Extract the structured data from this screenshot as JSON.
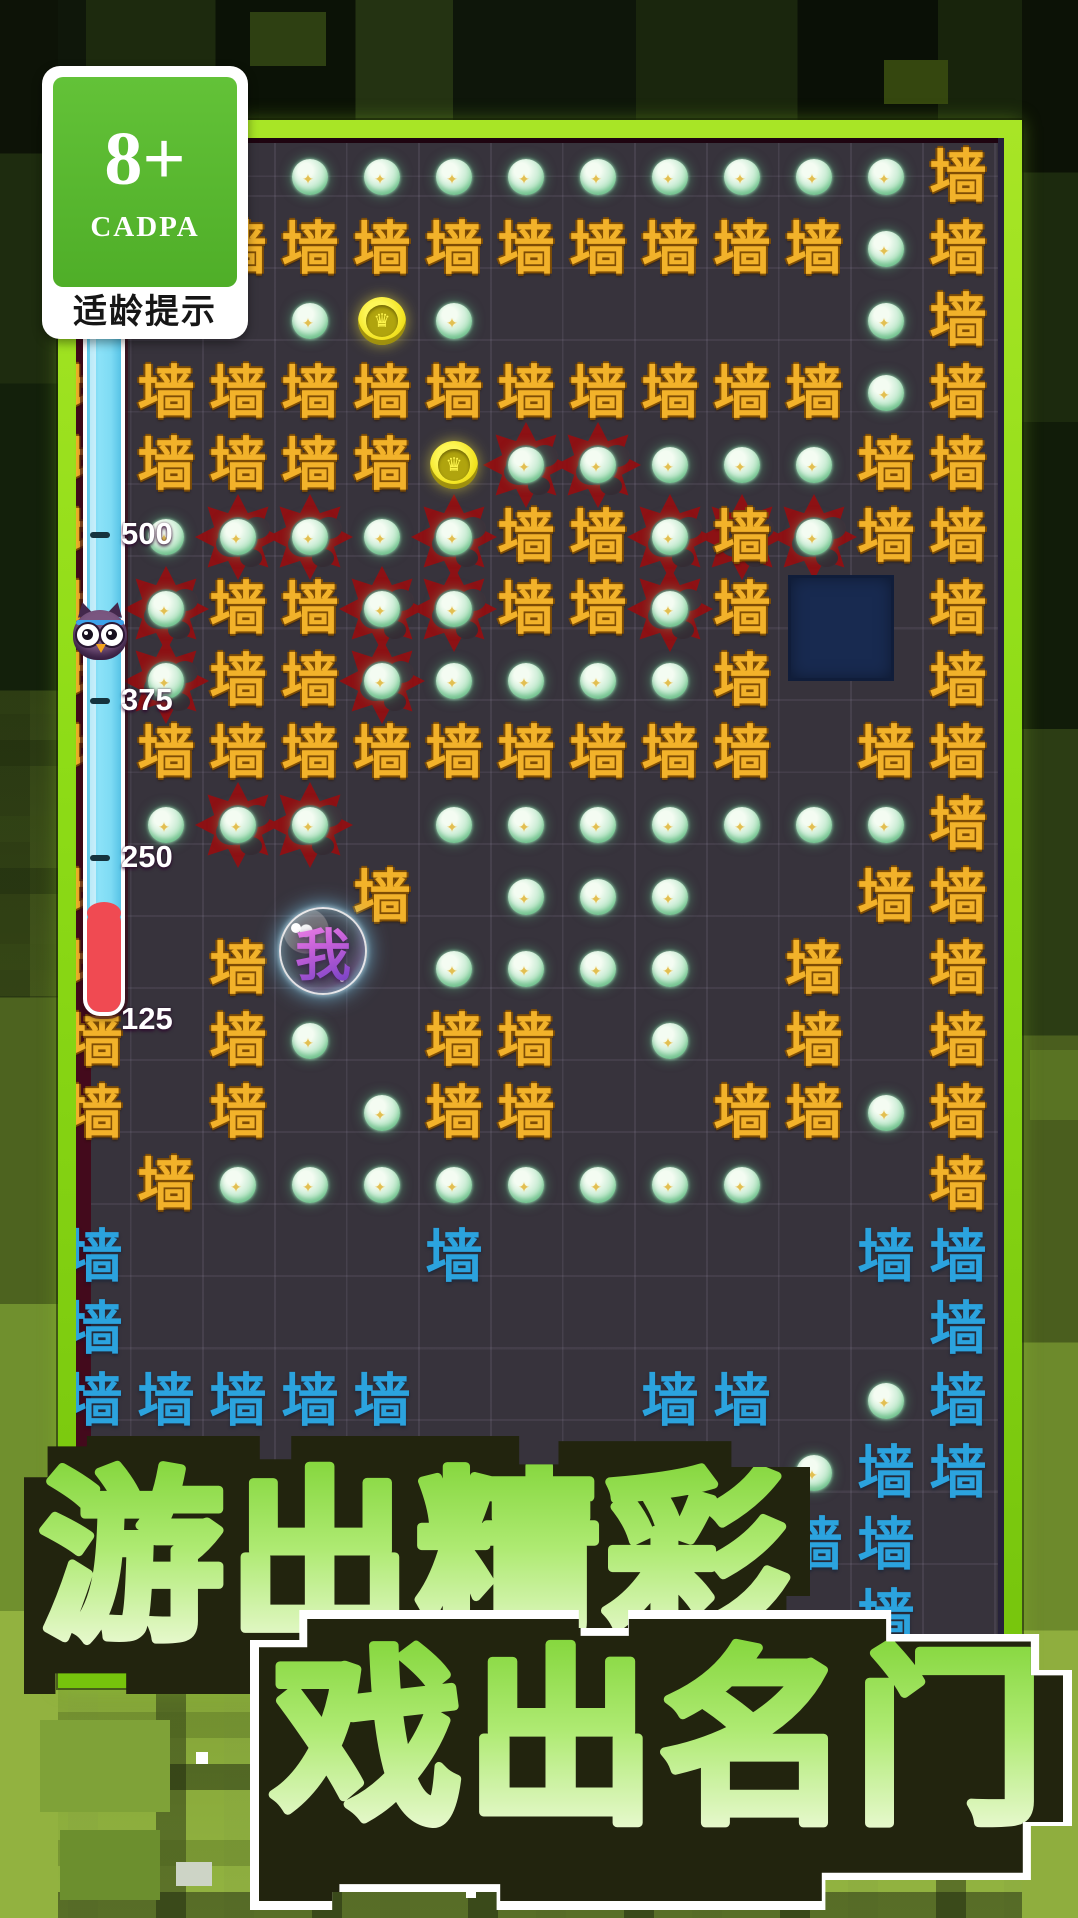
{
  "age_badge": {
    "rating": "8+",
    "org": "CADPA",
    "caption": "适龄提示"
  },
  "title": {
    "line1": "游出精彩",
    "line2": "戏出名门"
  },
  "meter": {
    "labels": [
      {
        "value": "500",
        "y": 535,
        "tick": true
      },
      {
        "value": "375",
        "y": 701,
        "tick": true
      },
      {
        "value": "250",
        "y": 858,
        "tick": true
      },
      {
        "value": "125",
        "y": 1020,
        "tick": false
      }
    ]
  },
  "icons": {
    "orb_star": "✦",
    "coin_crown": "♛",
    "owl": "owl-mascot"
  },
  "colors": {
    "frame_green": "#8edc17",
    "board_bg": "#37333c",
    "gold_wall": "#f2b22a",
    "blue_wall": "#2ba3de",
    "orb_green": "#a4dfb6",
    "coin_yellow": "#f3e422",
    "thorn_red": "#8d1114",
    "danger_red": "#f04a52",
    "meter_cyan": "#7edbf4",
    "navy_block": "#182a50",
    "title_green": "#8edb4a"
  },
  "board": {
    "wall_char": "墙",
    "player_char": "我",
    "gold_walls": [
      [
        12,
        0
      ],
      [
        2,
        1
      ],
      [
        3,
        1
      ],
      [
        4,
        1
      ],
      [
        5,
        1
      ],
      [
        6,
        1
      ],
      [
        7,
        1
      ],
      [
        8,
        1
      ],
      [
        9,
        1
      ],
      [
        10,
        1
      ],
      [
        12,
        1
      ],
      [
        12,
        2
      ],
      [
        0,
        3
      ],
      [
        1,
        3
      ],
      [
        2,
        3
      ],
      [
        3,
        3
      ],
      [
        4,
        3
      ],
      [
        5,
        3
      ],
      [
        6,
        3
      ],
      [
        7,
        3
      ],
      [
        8,
        3
      ],
      [
        9,
        3
      ],
      [
        10,
        3
      ],
      [
        12,
        3
      ],
      [
        0,
        4
      ],
      [
        1,
        4
      ],
      [
        2,
        4
      ],
      [
        3,
        4
      ],
      [
        4,
        4
      ],
      [
        11,
        4
      ],
      [
        12,
        4
      ],
      [
        0,
        5
      ],
      [
        6,
        5
      ],
      [
        7,
        5
      ],
      [
        11,
        5
      ],
      [
        12,
        5
      ],
      [
        0,
        6
      ],
      [
        2,
        6
      ],
      [
        3,
        6
      ],
      [
        6,
        6
      ],
      [
        7,
        6
      ],
      [
        9,
        6
      ],
      [
        12,
        6
      ],
      [
        0,
        7
      ],
      [
        2,
        7
      ],
      [
        3,
        7
      ],
      [
        9,
        7
      ],
      [
        12,
        7
      ],
      [
        0,
        8
      ],
      [
        1,
        8
      ],
      [
        2,
        8
      ],
      [
        3,
        8
      ],
      [
        4,
        8
      ],
      [
        5,
        8
      ],
      [
        6,
        8
      ],
      [
        7,
        8
      ],
      [
        8,
        8
      ],
      [
        9,
        8
      ],
      [
        11,
        8
      ],
      [
        12,
        8
      ],
      [
        12,
        9
      ],
      [
        0,
        10
      ],
      [
        4,
        10
      ],
      [
        11,
        10
      ],
      [
        12,
        10
      ],
      [
        0,
        11
      ],
      [
        2,
        11
      ],
      [
        10,
        11
      ],
      [
        12,
        11
      ],
      [
        0,
        12
      ],
      [
        2,
        12
      ],
      [
        5,
        12
      ],
      [
        6,
        12
      ],
      [
        10,
        12
      ],
      [
        12,
        12
      ],
      [
        0,
        13
      ],
      [
        2,
        13
      ],
      [
        5,
        13
      ],
      [
        6,
        13
      ],
      [
        9,
        13
      ],
      [
        10,
        13
      ],
      [
        12,
        13
      ],
      [
        1,
        14
      ],
      [
        12,
        14
      ]
    ],
    "thorn_walls": [
      [
        9,
        5
      ]
    ],
    "blue_walls": [
      [
        0,
        15
      ],
      [
        5,
        15
      ],
      [
        11,
        15
      ],
      [
        12,
        15
      ],
      [
        0,
        16
      ],
      [
        12,
        16
      ],
      [
        0,
        17
      ],
      [
        1,
        17
      ],
      [
        2,
        17
      ],
      [
        3,
        17
      ],
      [
        4,
        17
      ],
      [
        8,
        17
      ],
      [
        9,
        17
      ],
      [
        12,
        17
      ],
      [
        11,
        18
      ],
      [
        12,
        18
      ],
      [
        10,
        19
      ],
      [
        11,
        19
      ],
      [
        11,
        20
      ]
    ],
    "orbs": [
      [
        3,
        0
      ],
      [
        4,
        0
      ],
      [
        5,
        0
      ],
      [
        6,
        0
      ],
      [
        7,
        0
      ],
      [
        8,
        0
      ],
      [
        9,
        0
      ],
      [
        10,
        0
      ],
      [
        11,
        0
      ],
      [
        11,
        1
      ],
      [
        3,
        2
      ],
      [
        5,
        2
      ],
      [
        11,
        2
      ],
      [
        11,
        3
      ],
      [
        8,
        4
      ],
      [
        9,
        4
      ],
      [
        10,
        4
      ],
      [
        1,
        5
      ],
      [
        4,
        5
      ],
      [
        5,
        7
      ],
      [
        6,
        7
      ],
      [
        7,
        7
      ],
      [
        8,
        7
      ],
      [
        1,
        9
      ],
      [
        5,
        9
      ],
      [
        6,
        9
      ],
      [
        7,
        9
      ],
      [
        8,
        9
      ],
      [
        9,
        9
      ],
      [
        10,
        9
      ],
      [
        11,
        9
      ],
      [
        6,
        10
      ],
      [
        7,
        10
      ],
      [
        8,
        10
      ],
      [
        5,
        11
      ],
      [
        6,
        11
      ],
      [
        7,
        11
      ],
      [
        8,
        11
      ],
      [
        3,
        12
      ],
      [
        8,
        12
      ],
      [
        4,
        13
      ],
      [
        11,
        13
      ],
      [
        2,
        14
      ],
      [
        3,
        14
      ],
      [
        4,
        14
      ],
      [
        5,
        14
      ],
      [
        6,
        14
      ],
      [
        7,
        14
      ],
      [
        8,
        14
      ],
      [
        9,
        14
      ],
      [
        11,
        17
      ],
      [
        10,
        18
      ]
    ],
    "thorn_orbs": [
      [
        6,
        4
      ],
      [
        7,
        4
      ],
      [
        2,
        5
      ],
      [
        3,
        5
      ],
      [
        5,
        5
      ],
      [
        8,
        5
      ],
      [
        10,
        5
      ],
      [
        1,
        6
      ],
      [
        4,
        6
      ],
      [
        5,
        6
      ],
      [
        8,
        6
      ],
      [
        1,
        7
      ],
      [
        4,
        7
      ],
      [
        2,
        9
      ],
      [
        3,
        9
      ]
    ],
    "coins": [
      [
        4,
        2
      ],
      [
        5,
        4
      ]
    ],
    "navy_square": {
      "left": 712,
      "top": 437
    },
    "player": {
      "left": 203,
      "top": 769
    }
  }
}
